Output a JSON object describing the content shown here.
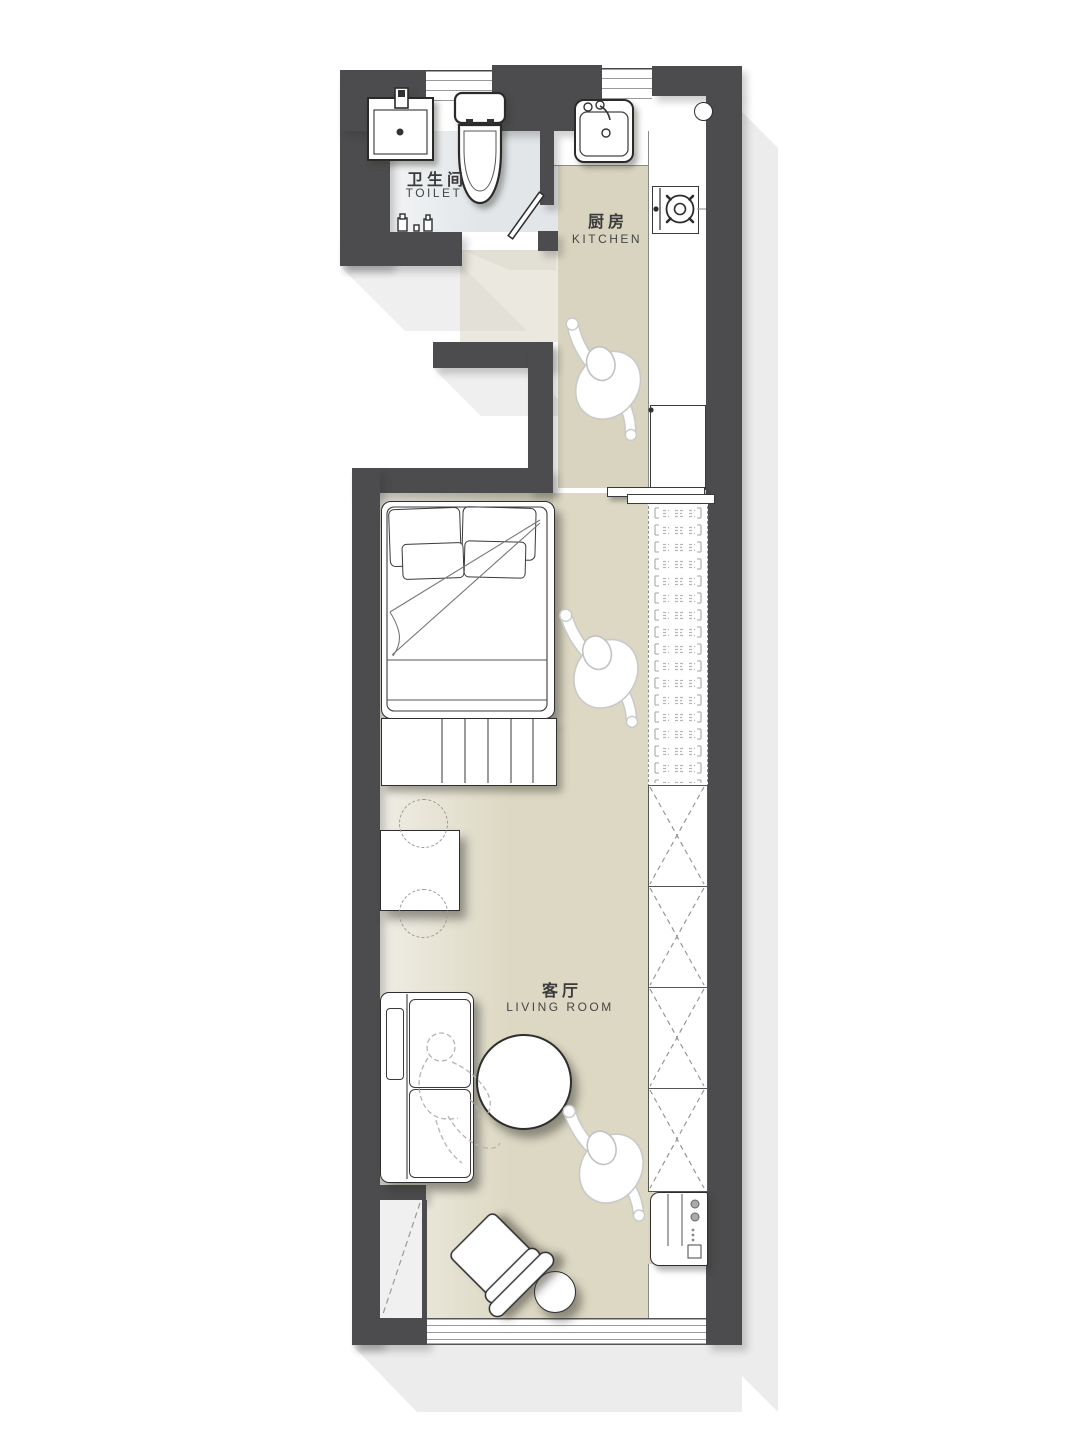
{
  "meta": {
    "type": "apartment floor plan",
    "view": "top-down architectural drawing"
  },
  "rooms": {
    "toilet": {
      "label_cn": "卫生间",
      "label_en": "TOILET"
    },
    "kitchen": {
      "label_cn": "厨房",
      "label_en": "KITCHEN"
    },
    "living_room": {
      "label_cn": "客厅",
      "label_en": "LIVING  ROOM"
    }
  },
  "colors": {
    "wall": "#4c4c4e",
    "floor_main": "#dcd8c3",
    "floor_corridor": "#d8d4bf",
    "floor_toilet": "#e2e6e9",
    "furniture": "#ffffff",
    "outline": "#2e2e2e",
    "hatch": "#b5b5b5",
    "exterior_shadow": "#ececec"
  },
  "fixtures": {
    "bathroom": [
      "bathroom-sink-icon",
      "toilet-wc-icon",
      "door-leaf-icon",
      "wall-hooks-icon"
    ],
    "kitchen": [
      "kitchen-sink-icon",
      "gas-stove-icon",
      "counter",
      "fridge-cabinet",
      "sliding-door",
      "counter-outlet-circle"
    ],
    "bedroom": [
      "double-bed",
      "pillows",
      "foot-bench",
      "hanging-wardrobe"
    ],
    "living": [
      "desk",
      "desk-chairs",
      "sofa",
      "round-table",
      "armchair",
      "side-stool",
      "storage-cabinets",
      "washing-machine-icon",
      "balcony-closet"
    ],
    "figures": [
      "walking-person",
      "walking-person",
      "walking-person",
      "seated-person-dashed"
    ]
  }
}
